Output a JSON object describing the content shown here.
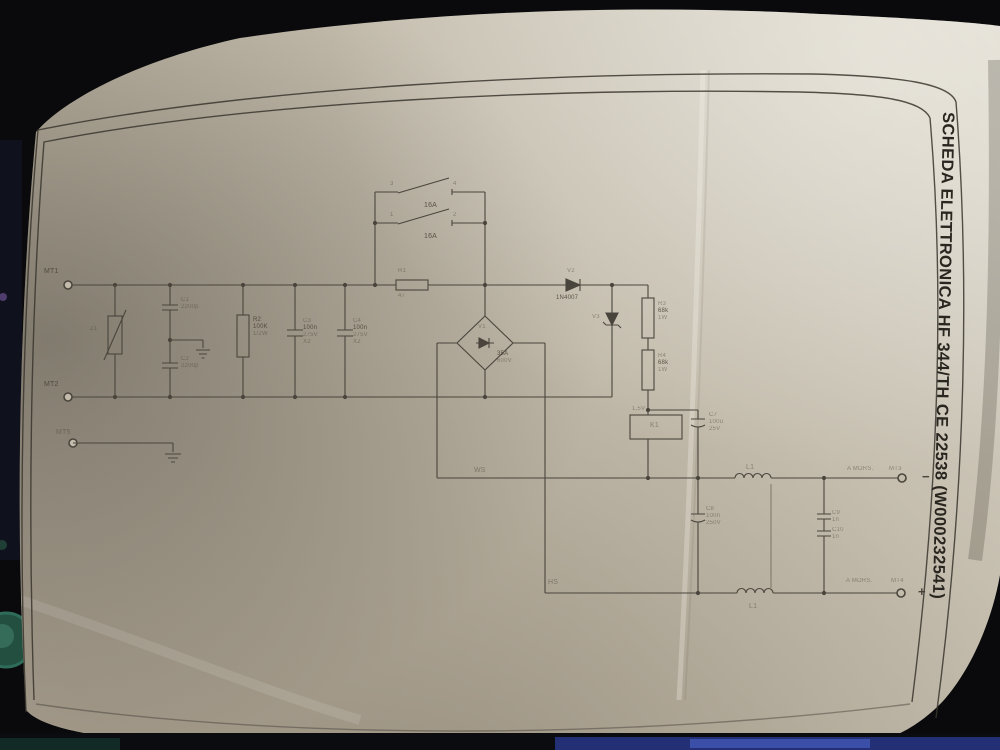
{
  "photo": {
    "title_vertical": "SCHEDA ELETTRONICA HF 344/TH CE 22538 (W000232541)"
  },
  "colors": {
    "background": "#0a0a0c",
    "paper": "#bdb5a5",
    "paper_light": "#dcd8cd",
    "paper_shadow": "#a89f8f",
    "ink": "#4a453c",
    "sticker_teal": "#2e6b58",
    "strip_blue": "#3446a0"
  },
  "schematic": {
    "labels": {
      "mt1": "MT1",
      "mt2": "MT2",
      "mt5": "MT5",
      "z1": "Z1",
      "c1": "C1",
      "c1_val": "2200p",
      "c2": "C2",
      "c2_val": "2200p",
      "r2": "R2",
      "r2_val": "100K",
      "r2_pow": "1/2W",
      "c3": "C3",
      "c3_val": "100n",
      "c3_volt": "275V",
      "c3_class": "X2",
      "c4": "C4",
      "c4_val": "100n",
      "c4_volt": "275V",
      "c4_class": "X2",
      "s1a_t1": "3",
      "s1a_t2": "4",
      "s1a_rating": "16A",
      "s1b_t1": "1",
      "s1b_t2": "2",
      "s1b_rating": "16A",
      "r1": "R1",
      "r1_val": "47",
      "v1": "V1",
      "v1_rating": "35A",
      "v1_volt": "600V",
      "v2": "V2",
      "v2_part": "1N4007",
      "v3": "V3",
      "r3": "R3",
      "r3_val": "68k",
      "r3_pow": "1W",
      "r4": "R4",
      "r4_val": "68k",
      "r4_pow": "1W",
      "k1": "K1",
      "k1_volt": "1,5V",
      "c7": "C7",
      "c7_val": "100u",
      "c7_volt": "25V",
      "c8": "C8",
      "c8_val": "100n",
      "c8_volt": "250V",
      "ws": "WS",
      "hs": "HS",
      "l1_top": "L1",
      "l1_bottom": "L1",
      "c9": "C9",
      "c9_val": "1n",
      "c10": "C10",
      "c10_val": "1n",
      "out_neg_note": "A MORS.",
      "out_neg_term": "MT3",
      "out_neg_sign": "−",
      "out_pos_note": "A MORS.",
      "out_pos_term": "MT4",
      "out_pos_sign": "+"
    }
  }
}
